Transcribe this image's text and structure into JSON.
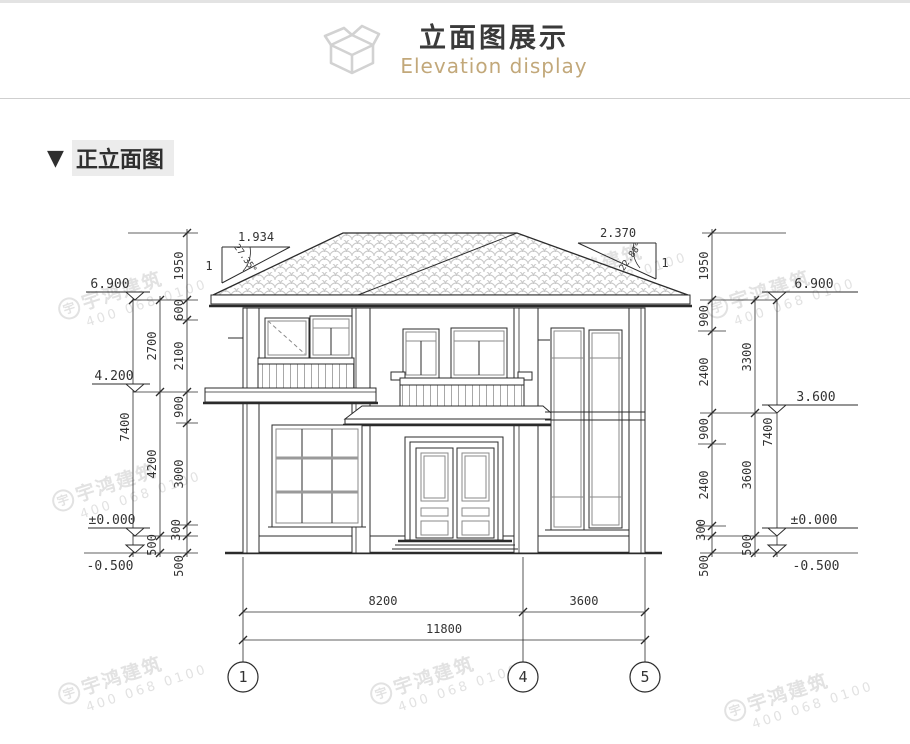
{
  "header": {
    "title": "立面图展示",
    "subtitle": "Elevation display",
    "icon": "isometric-box"
  },
  "section": {
    "marker": "▼",
    "title": "正立面图"
  },
  "watermark": {
    "logo": "宇",
    "name": "宇鸿建筑",
    "phone": "400 068 0100"
  },
  "colors": {
    "accent_gold": "#c2a87a",
    "line": "#2b2b2b",
    "roof_tile": "#c8c8c8",
    "watermark": "#e2e2e2"
  },
  "drawing": {
    "left": {
      "levels": [
        "6.900",
        "4.200",
        "±0.000",
        "-0.500"
      ],
      "inner": [
        "1950",
        "600",
        "2100",
        "900",
        "3000",
        "300",
        "500"
      ],
      "mid": [
        "2700",
        "4200",
        "500"
      ],
      "outer": [
        "7400"
      ],
      "slope": {
        "ratio": "1.934",
        "base": "1",
        "angle": "27.35°"
      }
    },
    "right": {
      "levels": [
        "6.900",
        "3.600",
        "±0.000",
        "-0.500"
      ],
      "inner": [
        "1950",
        "900",
        "2400",
        "900",
        "2400",
        "300",
        "500"
      ],
      "mid": [
        "3300",
        "3600",
        "500"
      ],
      "outer": [
        "7400"
      ],
      "slope": {
        "ratio": "2.370",
        "base": "1",
        "angle": "22.88°"
      }
    },
    "bottom": {
      "segments": [
        "8200",
        "3600"
      ],
      "total": "11800",
      "grids": [
        "1",
        "4",
        "5"
      ]
    }
  }
}
